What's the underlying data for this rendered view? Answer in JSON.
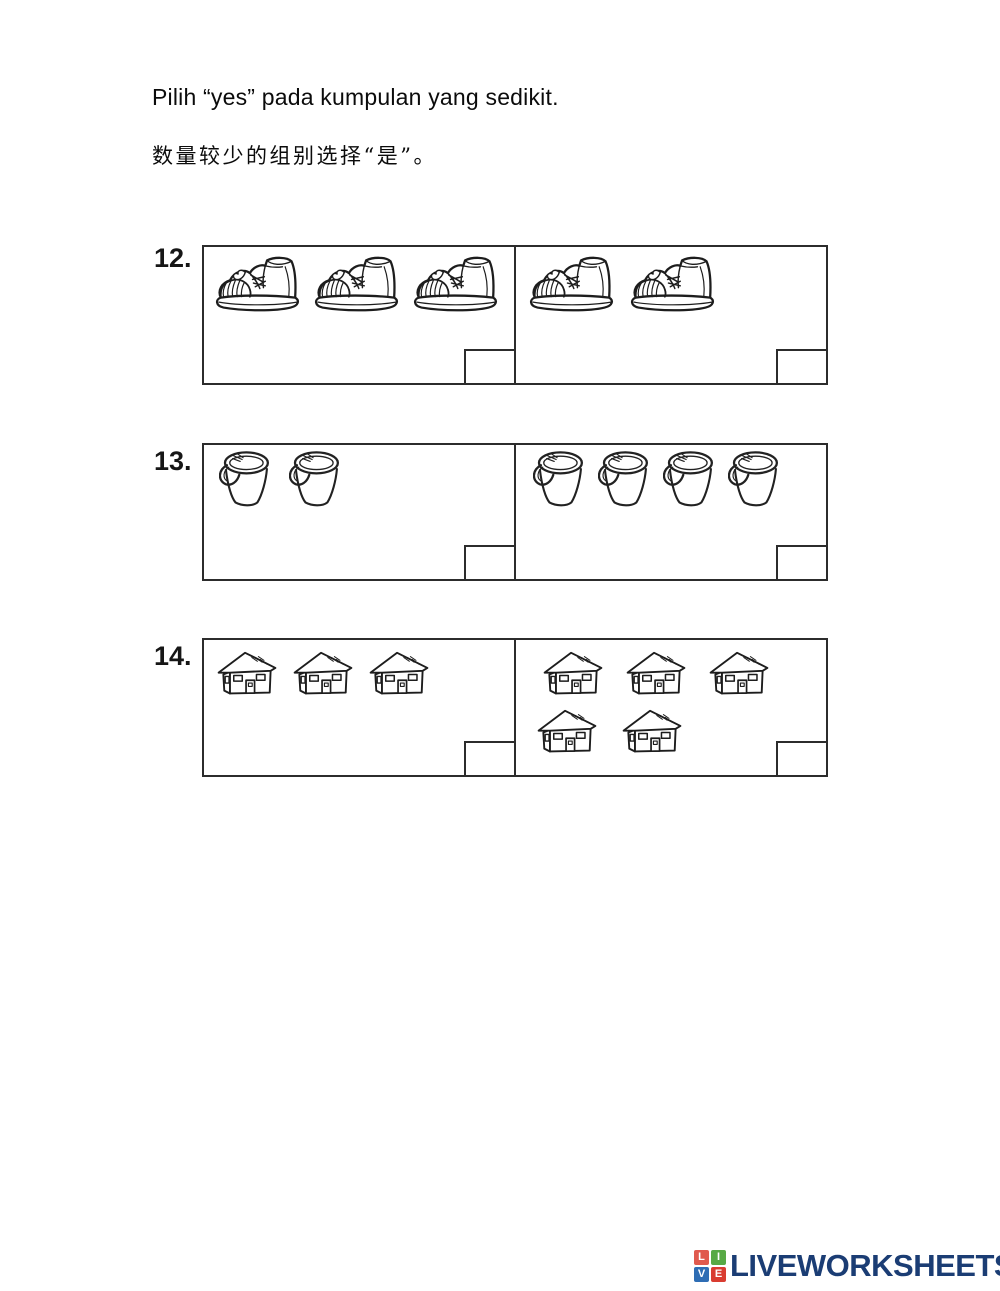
{
  "instructions": {
    "line1": "Pilih “yes” pada kumpulan yang sedikit.",
    "line2": "数量较少的组别选择“是”。"
  },
  "questions": [
    {
      "number": "12.",
      "item": "boot",
      "left": {
        "count": 3,
        "rows": [
          3
        ]
      },
      "right": {
        "count": 2,
        "rows": [
          2
        ]
      }
    },
    {
      "number": "13.",
      "item": "bucket",
      "left": {
        "count": 2,
        "rows": [
          2
        ]
      },
      "right": {
        "count": 4,
        "rows": [
          4
        ]
      }
    },
    {
      "number": "14.",
      "item": "house",
      "left": {
        "count": 3,
        "rows": [
          3
        ]
      },
      "right": {
        "count": 5,
        "rows": [
          3,
          2
        ]
      }
    }
  ],
  "footer": {
    "logo": {
      "letters": [
        "L",
        "I",
        "V",
        "E"
      ],
      "letter_colors": [
        "#e05a4e",
        "#57a945",
        "#2e6db4",
        "#d93c31"
      ],
      "text": "LIVEWORKSHEETS",
      "text_color": "#1b3d74"
    }
  }
}
